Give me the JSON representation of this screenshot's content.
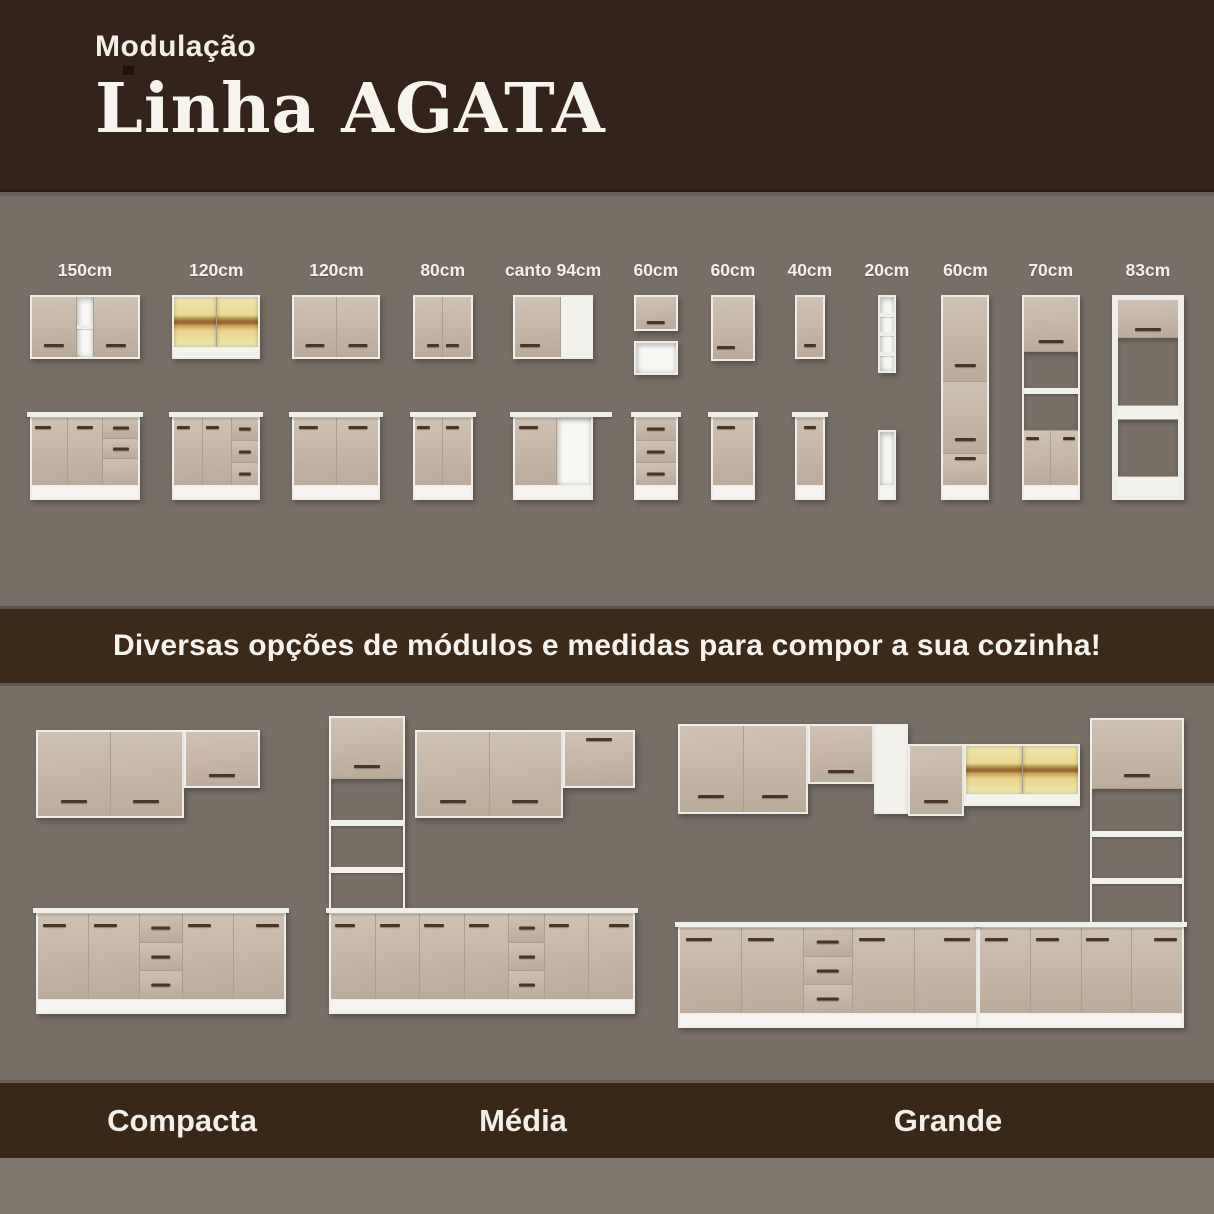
{
  "header": {
    "kicker": "Modulação",
    "title": "Linha AGATA"
  },
  "banner": {
    "text": "Diversas opções de módulos e medidas para compor a sua cozinha!"
  },
  "colors": {
    "brown_dark": "#33231A",
    "brown_banner": "#3B2919",
    "background_gray": "#776E66",
    "bottom_strip_gray": "#7E756D",
    "cabinet_tan": "#C4B5A6",
    "carcass_white": "#F2F1EC",
    "glass_yellow": "#EAD992",
    "handle_brown": "#473628",
    "text_white": "#F5F2EC"
  },
  "modules": [
    {
      "label": "150cm",
      "top": [
        {
          "w": 110,
          "h": 64,
          "cols": [
            {
              "f": 4.2,
              "t": "door",
              "h": "bc"
            },
            {
              "f": 1.6,
              "segs": [
                {
                  "t": "open",
                  "n": 1
                }
              ]
            },
            {
              "f": 4.2,
              "t": "door",
              "h": "bc"
            }
          ]
        }
      ],
      "bottom": [
        {
          "w": 110,
          "h": 84,
          "counter": 1,
          "plinth": 1,
          "cols": [
            {
              "t": "door",
              "h": "tl"
            },
            {
              "t": "door",
              "h": "tc"
            },
            {
              "segs": [
                {
                  "t": "drawer",
                  "h": "c"
                },
                {
                  "t": "drawer",
                  "h": "c"
                },
                {
                  "t": "blank",
                  "f": 1.3
                }
              ]
            }
          ]
        }
      ]
    },
    {
      "label": "120cm",
      "top": [
        {
          "w": 88,
          "h": 64,
          "band": 1,
          "cols": [
            {
              "t": "glass"
            },
            {
              "t": "glass"
            }
          ]
        }
      ],
      "bottom": [
        {
          "w": 88,
          "h": 84,
          "counter": 1,
          "plinth": 1,
          "cols": [
            {
              "t": "door",
              "h": "tl"
            },
            {
              "t": "door",
              "h": "tl"
            },
            {
              "f": 0.95,
              "segs": [
                {
                  "t": "drawer",
                  "h": "c"
                },
                {
                  "t": "drawer",
                  "h": "c"
                },
                {
                  "t": "drawer",
                  "h": "c"
                }
              ]
            }
          ]
        }
      ]
    },
    {
      "label": "120cm",
      "top": [
        {
          "w": 88,
          "h": 64,
          "cols": [
            {
              "t": "door",
              "h": "bc"
            },
            {
              "t": "door",
              "h": "bc"
            }
          ]
        }
      ],
      "bottom": [
        {
          "w": 88,
          "h": 84,
          "counter": 1,
          "plinth": 1,
          "cols": [
            {
              "t": "door",
              "h": "tl"
            },
            {
              "t": "door",
              "h": "tc"
            }
          ]
        }
      ]
    },
    {
      "label": "80cm",
      "top": [
        {
          "w": 60,
          "h": 64,
          "cols": [
            {
              "t": "door",
              "h": "br"
            },
            {
              "t": "door",
              "h": "bl"
            }
          ]
        }
      ],
      "bottom": [
        {
          "w": 60,
          "h": 84,
          "counter": 1,
          "plinth": 1,
          "cols": [
            {
              "t": "door",
              "h": "tl"
            },
            {
              "t": "door",
              "h": "tl"
            }
          ]
        }
      ]
    },
    {
      "label": "canto 94cm",
      "top": [
        {
          "w": 80,
          "h": 64,
          "cols": [
            {
              "f": 1.5,
              "t": "door",
              "h": "bl"
            },
            {
              "f": 1,
              "t": "white"
            }
          ]
        }
      ],
      "bottom": [
        {
          "w": 80,
          "h": 84,
          "counter": 1,
          "ext": 16,
          "plinth": 1,
          "cols": [
            {
              "f": 1.2,
              "t": "door",
              "h": "tl"
            },
            {
              "f": 1,
              "t": "open"
            }
          ]
        }
      ]
    },
    {
      "label": "60cm",
      "top": [
        {
          "w": 44,
          "h": 36,
          "cols": [
            {
              "t": "door",
              "h": "bc"
            }
          ]
        },
        {
          "w": 44,
          "h": 34,
          "cols": [
            {
              "t": "open"
            }
          ]
        }
      ],
      "bottom": [
        {
          "w": 44,
          "h": 84,
          "counter": 1,
          "plinth": 1,
          "cols": [
            {
              "segs": [
                {
                  "t": "drawer",
                  "h": "c"
                },
                {
                  "t": "drawer",
                  "h": "c"
                },
                {
                  "t": "drawer",
                  "h": "c"
                }
              ]
            }
          ]
        }
      ]
    },
    {
      "label": "60cm",
      "top": [
        {
          "w": 44,
          "h": 66,
          "cols": [
            {
              "t": "door",
              "h": "bl"
            }
          ]
        }
      ],
      "bottom": [
        {
          "w": 44,
          "h": 84,
          "counter": 1,
          "plinth": 1,
          "cols": [
            {
              "t": "door",
              "h": "tl"
            }
          ]
        }
      ]
    },
    {
      "label": "40cm",
      "top": [
        {
          "w": 30,
          "h": 64,
          "cols": [
            {
              "t": "door",
              "h": "bc"
            }
          ]
        }
      ],
      "bottom": [
        {
          "w": 30,
          "h": 84,
          "counter": 1,
          "plinth": 1,
          "cols": [
            {
              "t": "door",
              "h": "tc"
            }
          ]
        }
      ]
    },
    {
      "label": "20cm",
      "top": [
        {
          "w": 18,
          "h": 78,
          "cols": [
            {
              "segs": [
                {
                  "t": "open",
                  "n": 3
                }
              ]
            }
          ]
        }
      ],
      "bottom": [
        {
          "w": 18,
          "h": 70,
          "plinth": 1,
          "cols": [
            {
              "t": "open"
            }
          ]
        }
      ]
    },
    {
      "label": "60cm",
      "full": [
        {
          "w": 48,
          "h": 205,
          "plinth": 1,
          "cols": [
            {
              "segs": [
                {
                  "t": "door",
                  "f": 4,
                  "h": "bc"
                },
                {
                  "t": "door",
                  "f": 3.4,
                  "h": "bc"
                },
                {
                  "t": "drawer",
                  "f": 1.5,
                  "h": "tc"
                }
              ]
            }
          ]
        }
      ]
    },
    {
      "label": "70cm",
      "full": [
        {
          "w": 58,
          "h": 205,
          "plinth": 1,
          "cols": [
            {
              "segs": [
                {
                  "t": "door",
                  "f": 1.9,
                  "h": "bc"
                },
                {
                  "t": "niche",
                  "f": 2.7,
                  "n": 1
                },
                {
                  "t": "pair",
                  "f": 1.9
                }
              ]
            }
          ]
        }
      ]
    },
    {
      "label": "83cm",
      "full": [
        {
          "w": 72,
          "h": 205,
          "cls": "frame",
          "cols": [
            {
              "segs": [
                {
                  "t": "door",
                  "f": 1.6,
                  "h": "bc"
                },
                {
                  "t": "niche",
                  "f": 2.9
                },
                {
                  "t": "white",
                  "f": 0.6
                },
                {
                  "t": "niche",
                  "f": 2.4
                },
                {
                  "t": "white",
                  "f": 0.8
                }
              ]
            }
          ]
        }
      ]
    }
  ],
  "kitchens": [
    {
      "label": "Compacta",
      "w": 280,
      "cabs": [
        {
          "x": 20,
          "y": 30,
          "w": 148,
          "h": 88,
          "cols": [
            {
              "t": "door",
              "h": "bc"
            },
            {
              "t": "door",
              "h": "bc"
            }
          ]
        },
        {
          "x": 168,
          "y": 30,
          "w": 76,
          "h": 58,
          "cols": [
            {
              "t": "door",
              "h": "bc"
            }
          ]
        },
        {
          "x": 20,
          "y": 212,
          "w": 250,
          "h": 102,
          "counter": 1,
          "plinth": 1,
          "cols": [
            {
              "t": "door",
              "h": "tl"
            },
            {
              "t": "door",
              "h": "tl"
            },
            {
              "f": 0.85,
              "segs": [
                {
                  "t": "drawer",
                  "h": "c"
                },
                {
                  "t": "drawer",
                  "h": "c"
                },
                {
                  "t": "drawer",
                  "h": "c"
                }
              ]
            },
            {
              "t": "door",
              "h": "tl"
            },
            {
              "t": "door",
              "h": "tr"
            }
          ]
        }
      ]
    },
    {
      "label": "Média",
      "w": 330,
      "cabs": [
        {
          "x": 14,
          "y": 16,
          "w": 76,
          "h": 200,
          "cols": [
            {
              "segs": [
                {
                  "t": "door",
                  "f": 1.5,
                  "h": "bc"
                },
                {
                  "t": "niche",
                  "f": 3.4,
                  "n": 2
                }
              ]
            }
          ]
        },
        {
          "x": 100,
          "y": 30,
          "w": 148,
          "h": 88,
          "cols": [
            {
              "t": "door",
              "h": "bc"
            },
            {
              "t": "door",
              "h": "bc"
            }
          ]
        },
        {
          "x": 248,
          "y": 30,
          "w": 72,
          "h": 58,
          "cols": [
            {
              "t": "door",
              "h": "tc"
            }
          ]
        },
        {
          "x": 14,
          "y": 212,
          "w": 306,
          "h": 102,
          "counter": 1,
          "plinth": 1,
          "cols": [
            {
              "t": "door",
              "h": "tl"
            },
            {
              "t": "door",
              "h": "tl"
            },
            {
              "t": "door",
              "h": "tl"
            },
            {
              "t": "door",
              "h": "tl"
            },
            {
              "f": 0.8,
              "segs": [
                {
                  "t": "drawer",
                  "h": "c"
                },
                {
                  "t": "drawer",
                  "h": "c"
                },
                {
                  "t": "drawer",
                  "h": "c"
                }
              ]
            },
            {
              "t": "door",
              "h": "tl"
            },
            {
              "t": "door",
              "h": "tr"
            }
          ]
        }
      ]
    },
    {
      "label": "Grande",
      "w": 534,
      "cabs": [
        {
          "x": 14,
          "y": 24,
          "w": 130,
          "h": 90,
          "cols": [
            {
              "t": "door",
              "h": "bc"
            },
            {
              "t": "door",
              "h": "bc"
            }
          ]
        },
        {
          "x": 144,
          "y": 24,
          "w": 66,
          "h": 60,
          "cols": [
            {
              "t": "door",
              "h": "bc"
            }
          ]
        },
        {
          "x": 210,
          "y": 24,
          "w": 34,
          "h": 90,
          "cols": [
            {
              "t": "white"
            }
          ]
        },
        {
          "x": 244,
          "y": 44,
          "w": 56,
          "h": 72,
          "cols": [
            {
              "t": "door",
              "h": "bc"
            }
          ]
        },
        {
          "x": 300,
          "y": 44,
          "w": 116,
          "h": 62,
          "band": 1,
          "cols": [
            {
              "t": "glass"
            },
            {
              "t": "glass"
            }
          ]
        },
        {
          "x": 426,
          "y": 18,
          "w": 94,
          "h": 210,
          "cols": [
            {
              "segs": [
                {
                  "t": "door",
                  "f": 1.6,
                  "h": "bc"
                },
                {
                  "t": "niche",
                  "f": 3.2,
                  "n": 2
                }
              ]
            }
          ]
        },
        {
          "x": 14,
          "y": 226,
          "w": 300,
          "h": 102,
          "counter": 1,
          "plinth": 1,
          "cols": [
            {
              "t": "door",
              "h": "tl"
            },
            {
              "t": "door",
              "h": "tl"
            },
            {
              "f": 0.8,
              "segs": [
                {
                  "t": "drawer",
                  "h": "c"
                },
                {
                  "t": "drawer",
                  "h": "c"
                },
                {
                  "t": "drawer",
                  "h": "c"
                }
              ]
            },
            {
              "t": "door",
              "h": "tl"
            },
            {
              "t": "door",
              "h": "tr"
            }
          ]
        },
        {
          "x": 314,
          "y": 226,
          "w": 206,
          "h": 102,
          "counter": 1,
          "plinth": 1,
          "cols": [
            {
              "t": "door",
              "h": "tl"
            },
            {
              "t": "door",
              "h": "tl"
            },
            {
              "t": "door",
              "h": "tl"
            },
            {
              "t": "door",
              "h": "tr"
            }
          ]
        }
      ]
    }
  ],
  "kitchen_label_positions_px": [
    182,
    523,
    948
  ]
}
